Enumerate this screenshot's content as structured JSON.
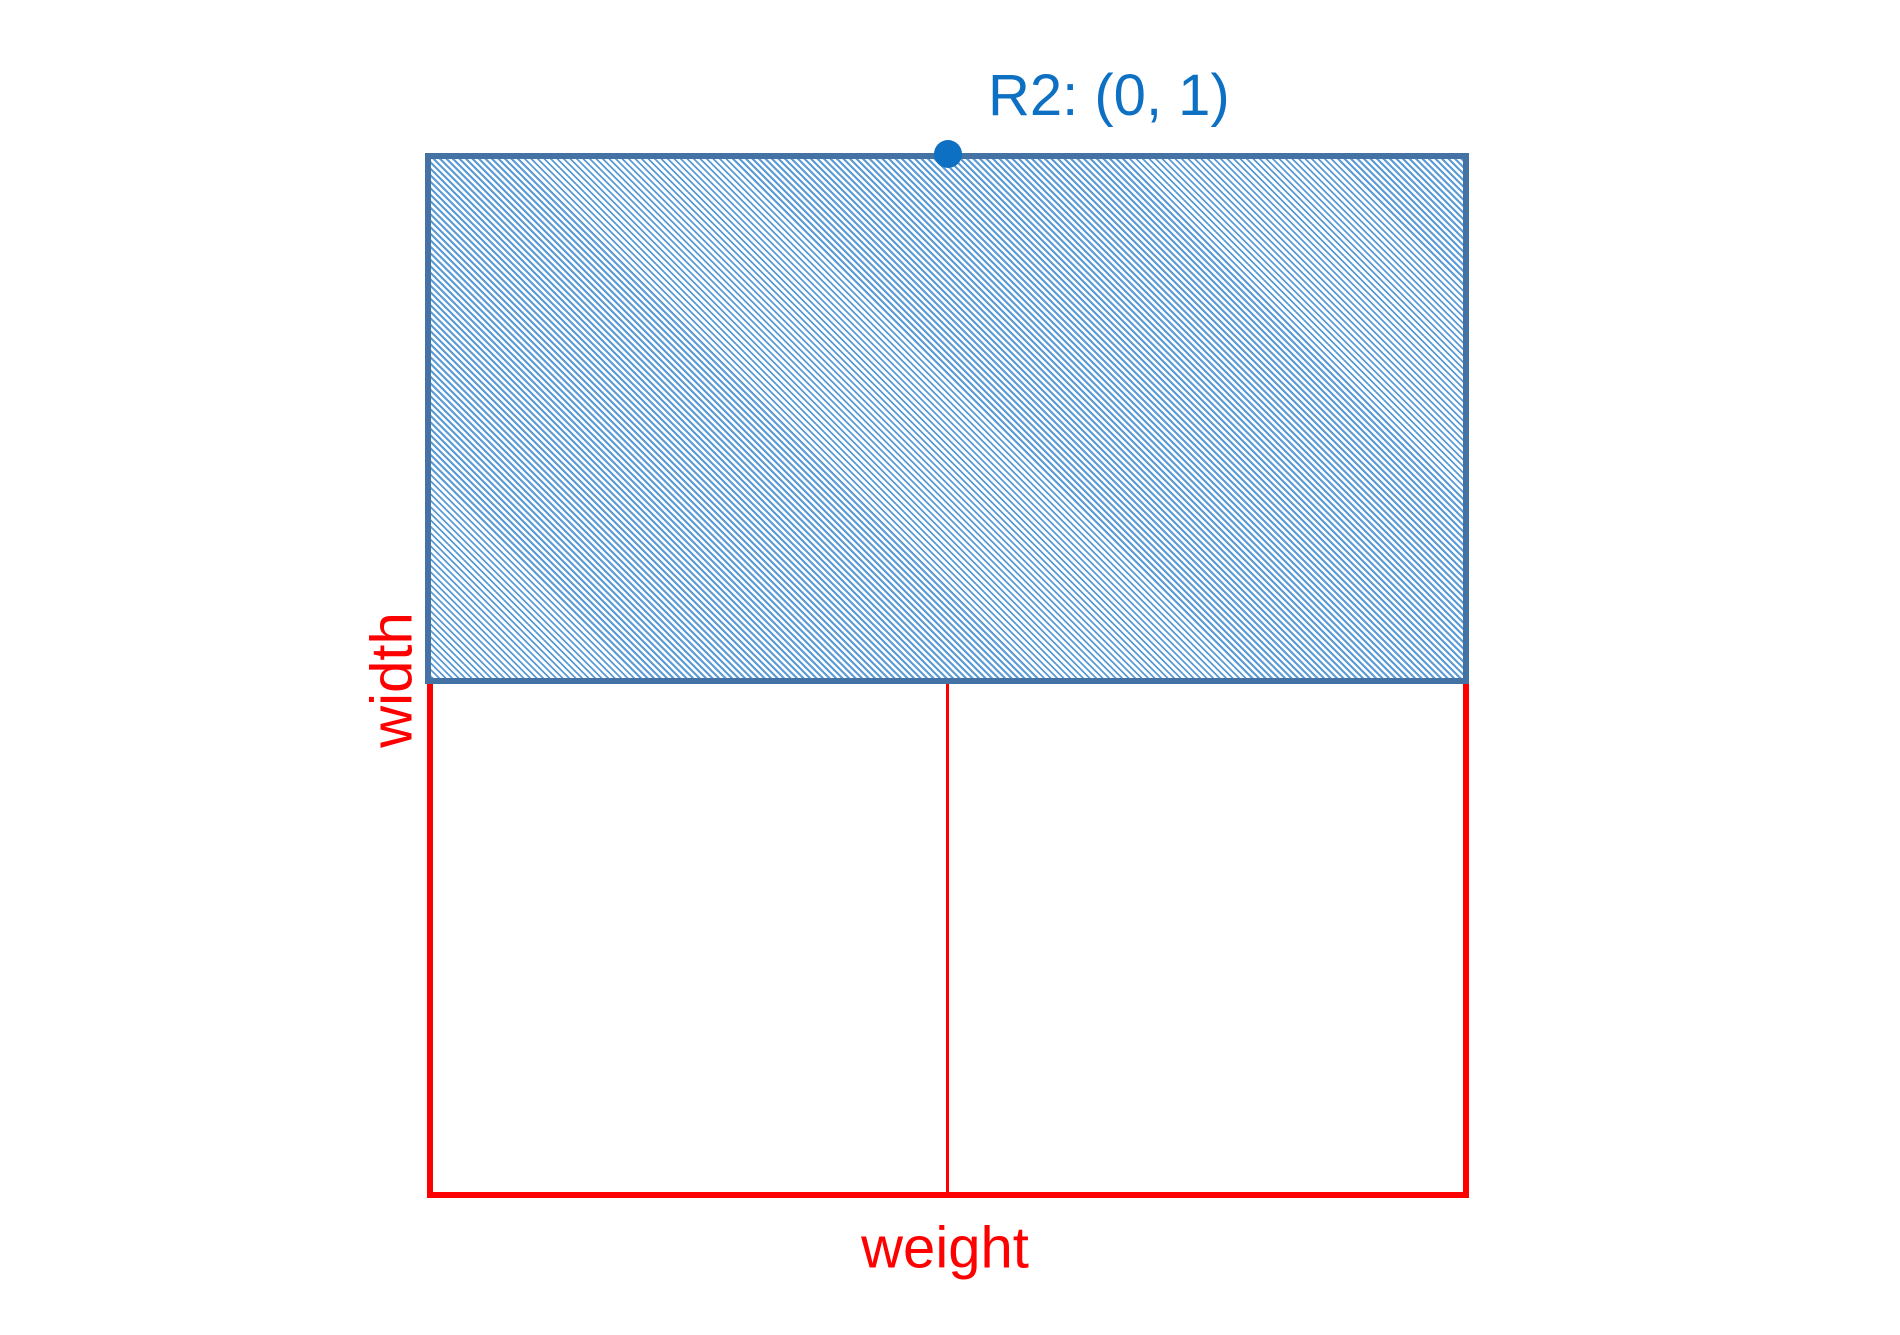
{
  "diagram": {
    "point_label": "R2: (0, 1)",
    "y_axis_label": "width",
    "x_axis_label": "weight",
    "colors": {
      "red": "#ff0000",
      "accent_blue": "#0d70c2",
      "rect_border_blue": "#4472a4",
      "hatch_blue": "#5b9bd5",
      "background": "#ffffff"
    }
  }
}
